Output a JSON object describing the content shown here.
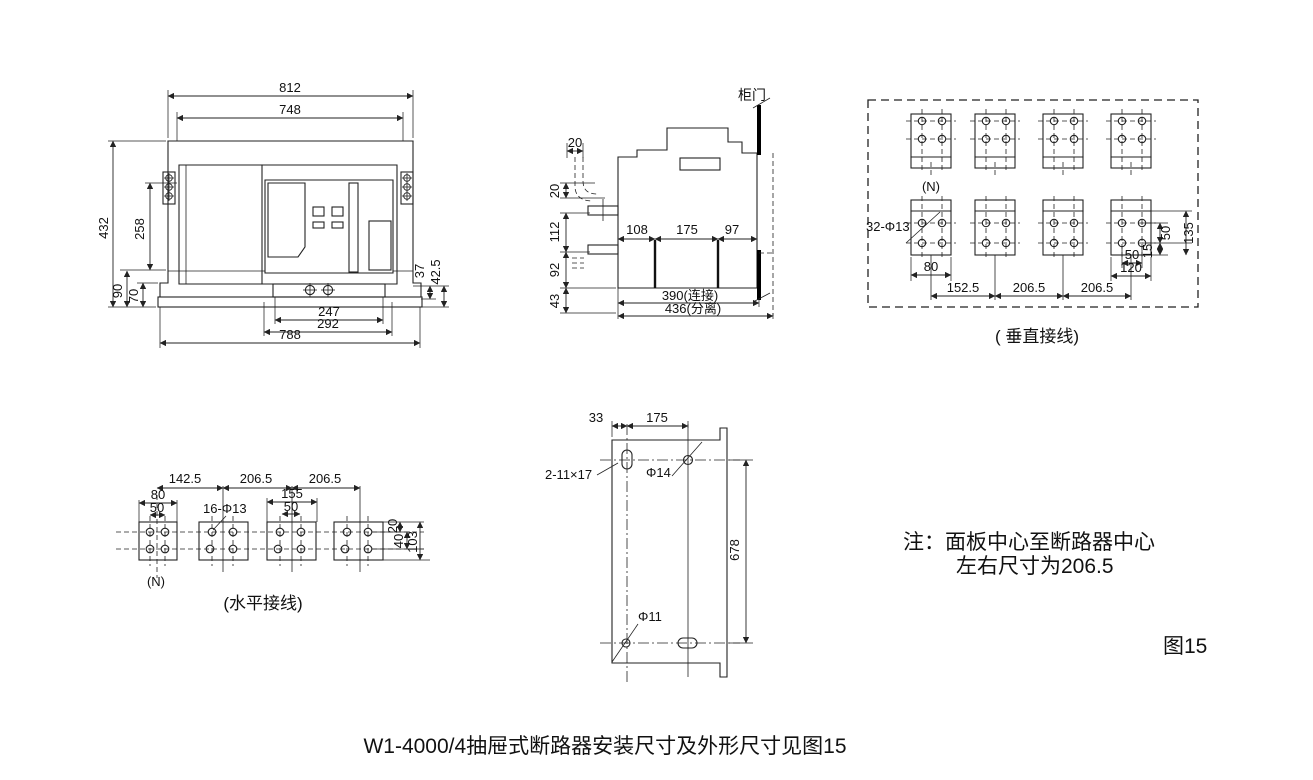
{
  "caption": "W1-4000/4抽屉式断路器安装尺寸及外形尺寸见图15",
  "note": {
    "line1": "注：面板中心至断路器中心",
    "line2": "左右尺寸为206.5",
    "figure_label": "图15"
  },
  "front_view": {
    "d812": "812",
    "d748": "748",
    "d432": "432",
    "d258": "258",
    "d90": "90",
    "d70": "70",
    "d37": "37",
    "d42_5": "42.5",
    "d247": "247",
    "d292": "292",
    "d788": "788"
  },
  "side_view": {
    "door_label": "柜门",
    "d20_top": "20",
    "d20": "20",
    "d112": "112",
    "d92": "92",
    "d43": "43",
    "d108": "108",
    "d175": "175",
    "d97": "97",
    "d390": "390(连接)",
    "d436": "436(分离)"
  },
  "vertical_view": {
    "caption": "( 垂直接线)",
    "n_label": "(N)",
    "hole_label": "32-Φ13",
    "d80": "80",
    "d152_5": "152.5",
    "d206_5a": "206.5",
    "d206_5b": "206.5",
    "d135": "135",
    "d50v": "50",
    "d15": "15",
    "d50h": "50",
    "d120": "120"
  },
  "horizontal_view": {
    "caption": "(水平接线)",
    "n_label": "(N)",
    "hole_label": "16-Φ13",
    "d142_5": "142.5",
    "d206_5a": "206.5",
    "d206_5b": "206.5",
    "d80": "80",
    "d50": "50",
    "d155": "155",
    "d50b": "50",
    "d20": "20",
    "d40": "40",
    "d103": "103"
  },
  "plate_view": {
    "slot_label": "2-11×17",
    "hole14_label": "Φ14",
    "hole11_label": "Φ11",
    "d33": "33",
    "d175": "175",
    "d678": "678"
  }
}
